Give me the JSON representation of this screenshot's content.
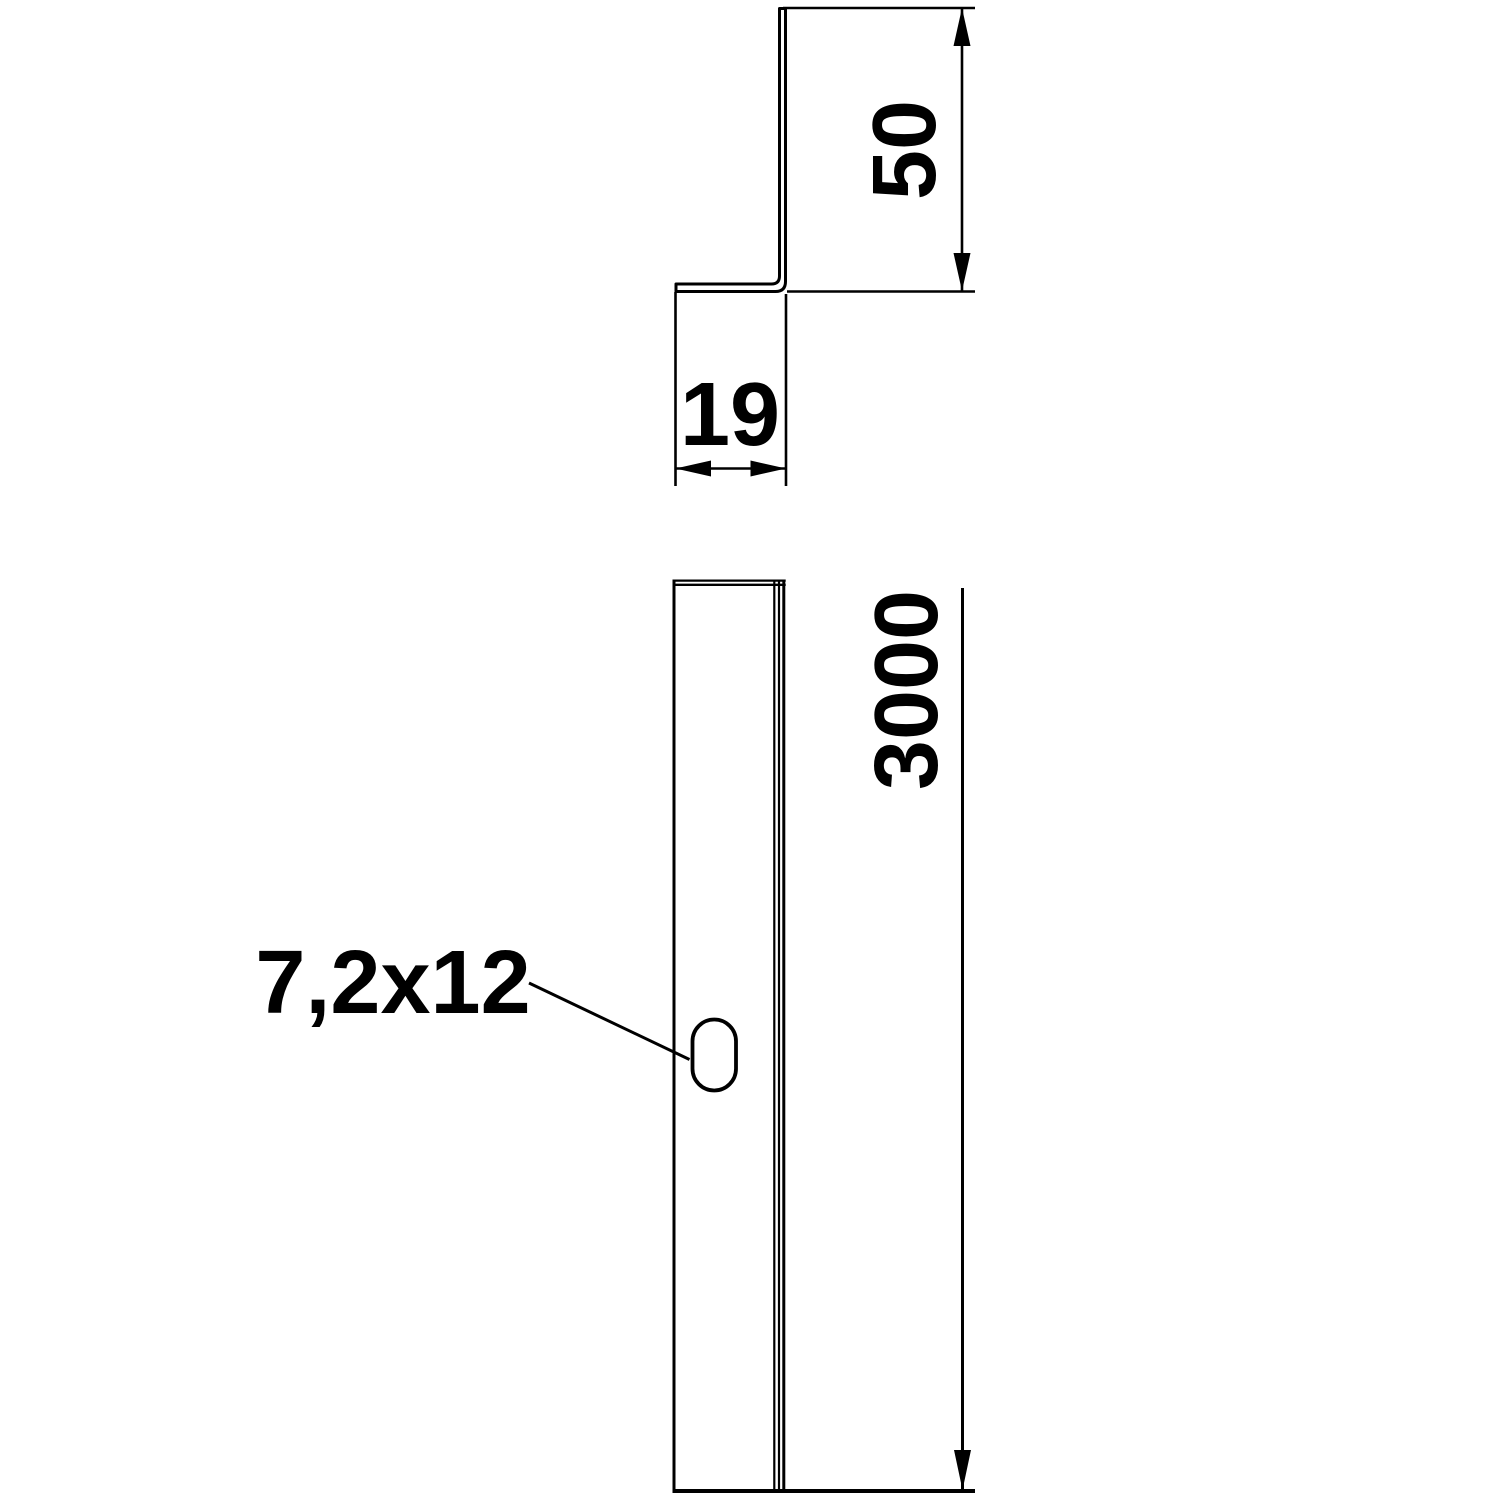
{
  "drawing": {
    "background_color": "#ffffff",
    "line_color": "#000000",
    "views": {
      "cross_section": {
        "description": "Z-profile cross section, top view",
        "dimensions": {
          "height_label": "50",
          "depth_label": "19"
        }
      },
      "side": {
        "description": "profile side view with slotted hole",
        "dimensions": {
          "length_label": "3000"
        },
        "slot_label": "7,2x12"
      }
    }
  }
}
